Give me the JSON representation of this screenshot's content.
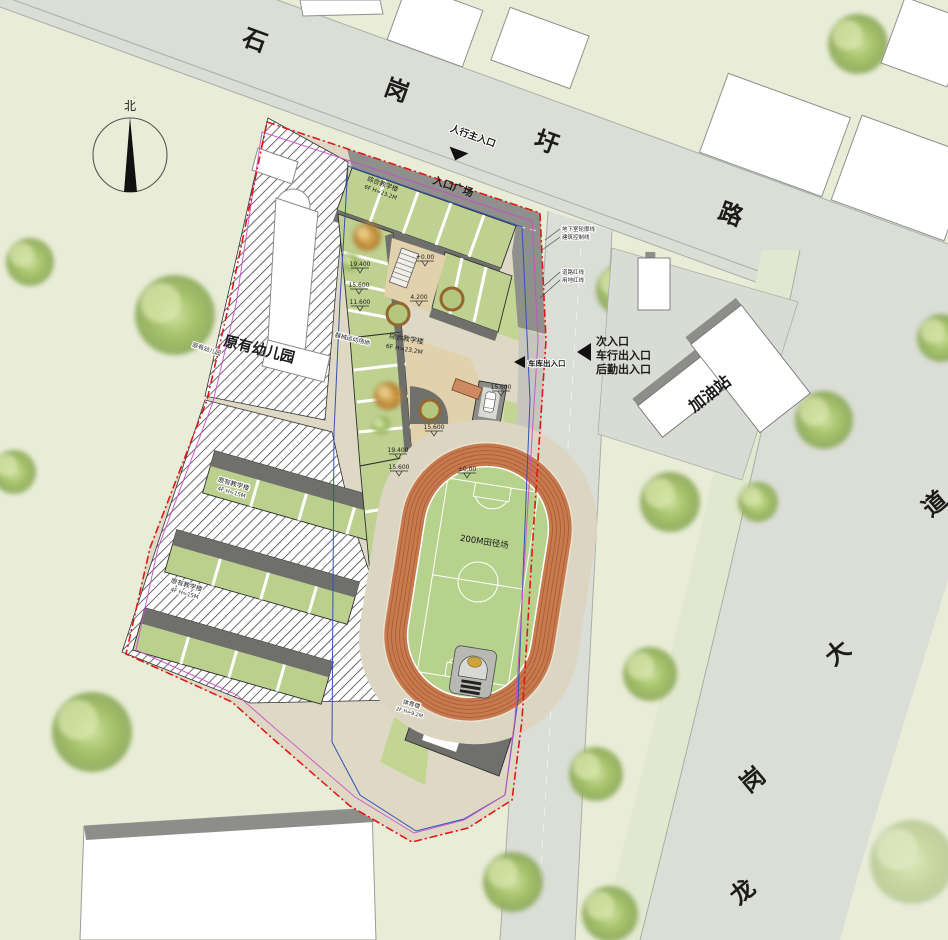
{
  "north_label": "北",
  "roads": {
    "top": {
      "chars": [
        "石",
        "岗",
        "圩",
        "路"
      ]
    },
    "right": {
      "chars": [
        "龙",
        "岗",
        "大",
        "道"
      ]
    }
  },
  "entrances": {
    "main": "人行主入口",
    "secondary_lines": [
      "次入口",
      "车行出入口",
      "后勤出入口"
    ],
    "garage": "车库出入口"
  },
  "areas": {
    "plaza": "入口广场",
    "track": "200M田径场",
    "equipment": "器械运动场地",
    "gas_station": "加油站"
  },
  "buildings": {
    "teaching_top": {
      "name": "综合教学楼",
      "spec": "6F H=23.2M"
    },
    "teaching_mid": {
      "name": "综合教学楼",
      "spec": "6F H=23.2M"
    },
    "existing_kindergarten": "原有幼儿园",
    "existing_kindergarten_small": "原有幼儿园",
    "existing_teaching_1": {
      "name": "原有教学楼",
      "spec": "4F H=15M"
    },
    "existing_teaching_2": {
      "name": "原有教学楼",
      "spec": "4F H=15M"
    },
    "gym": {
      "name": "体育楼",
      "spec": "2F H=9.2M"
    }
  },
  "annotations": {
    "lines": [
      "地下室轮廓线",
      "建筑控制线",
      "道路红线",
      "用地红线"
    ]
  },
  "elevations": [
    "19.400",
    "15.600",
    "11.600",
    "+0.00",
    "4.200",
    "15.600",
    "19.400",
    "15.600",
    "15.600",
    "±0.00"
  ],
  "colors": {
    "background": "#e9edd8",
    "road": "#dbded7",
    "plaza": "#8f8f8b",
    "roof_green": "#bed190",
    "track_orange": "#c87a4e",
    "field_green": "#b7d28c",
    "boundary_red": "#e01818",
    "control_blue": "#3352b5",
    "redline_magenta": "#c94ec9"
  }
}
